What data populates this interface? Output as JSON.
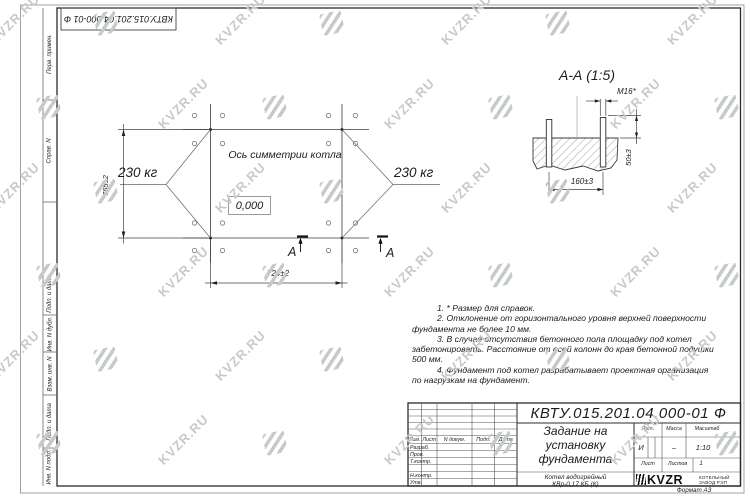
{
  "watermark": {
    "text": "KVZR.RU"
  },
  "stamp": {
    "text": "КВТУ.015.201.04.000-01 Ф"
  },
  "margin_labels": [
    "Перв. примен.",
    "Справ. N",
    "Подп. и дата",
    "Инв. N дубл.",
    "Взам. инв. N",
    "Подп. и дата",
    "Инв. N подл."
  ],
  "plan": {
    "axis_label": "Ось симметрии котла",
    "elevation": "0,000",
    "load_left": "230 кг",
    "load_right": "230 кг",
    "dim_height": "765±2",
    "dim_width": "724±2",
    "section_letter_1": "А",
    "section_letter_2": "А"
  },
  "section_view": {
    "title": "А-А (1:5)",
    "bolt_thread": "М16*",
    "dim_embed": "50±3",
    "dim_spacing": "160±3"
  },
  "notes_lines": [
    "1. * Размер для справок.",
    "2. Отклонение от горизонтального уровня верхней поверхности",
    "фундамента не более 10 мм.",
    "3. В случае отсутствия бетонного пола площадку под котел",
    "забетонировать. Расстояние от осей колонн до края бетонной подушки",
    "500 мм.",
    "4. Фундамент под котел разрабатывает проектная организация",
    "по нагрузкам на фундамент."
  ],
  "title_block": {
    "doc_number": "КВТУ.015.201.04.000-01 Ф",
    "title_line1": "Задание на",
    "title_line2": "установку",
    "title_line3": "фундамента",
    "product_line1": "Котел водогрейный",
    "product_line2": "КВр-0,17 КБ (К)",
    "col_izm": "Изм.",
    "col_list": "Лист",
    "col_ndoc": "N докум.",
    "col_podp": "Подп.",
    "col_data": "Дата",
    "row_razrab": "Разраб.",
    "row_prov": "Пров.",
    "row_tkontr": "Т.контр.",
    "row_nkontr": "Н.контр.",
    "row_utv": "Утв.",
    "lit_label": "Лит.",
    "mass_label": "Масса",
    "scale_label": "Масштаб",
    "lit_value": "И",
    "mass_value": "–",
    "scale_value": "1:10",
    "sheet_label": "Лист",
    "sheets_label": "Листов",
    "sheets_value": "1",
    "logo_text": "KVZR",
    "logo_sub1": "КОТЕЛЬНЫЙ",
    "logo_sub2": "ЗАВОД РЭП",
    "format_label": "Формат А3"
  }
}
